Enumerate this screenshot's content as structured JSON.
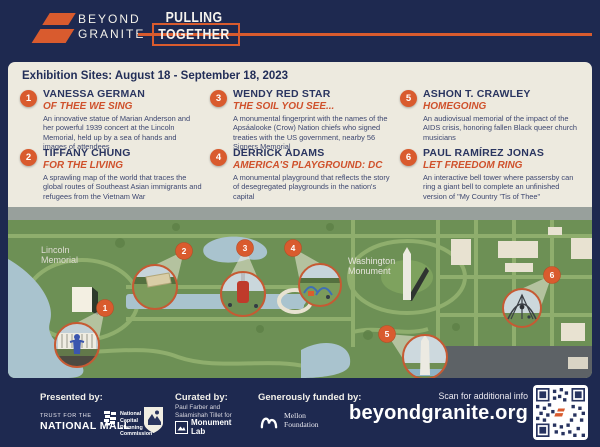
{
  "header": {
    "brand_line1": "BEYOND",
    "brand_line2": "GRANITE",
    "title_line1": "PULLING",
    "title_line2": "TOGETHER"
  },
  "banner": "Exhibition Sites: August 18 - September 18, 2023",
  "sites": [
    {
      "num": "1",
      "artist": "VANESSA GERMAN",
      "title": "OF THEE WE SING",
      "desc": "An innovative statue of Marian Anderson and her powerful 1939 concert at the Lincoln Memorial, held up by a sea of hands and images of attendees"
    },
    {
      "num": "2",
      "artist": "TIFFANY CHUNG",
      "title": "FOR THE LIVING",
      "desc": "A sprawling map of the world that traces the global routes of Southeast Asian immigrants and refugees from the Vietnam War"
    },
    {
      "num": "3",
      "artist": "WENDY RED STAR",
      "title": "THE SOIL YOU SEE...",
      "desc": "A monumental fingerprint with the names of the Apsáalooke (Crow) Nation chiefs who signed treaties with the US government, nearby 56 Signers Memorial"
    },
    {
      "num": "4",
      "artist": "DERRICK ADAMS",
      "title": "AMERICA'S PLAYGROUND: DC",
      "desc": "A monumental playground that reflects the story of desegregated playgrounds in the nation's capital"
    },
    {
      "num": "5",
      "artist": "ASHON T. CRAWLEY",
      "title": "HOMEGOING",
      "desc": "An audiovisual memorial of the impact of the AIDS crisis, honoring fallen Black queer church musicians"
    },
    {
      "num": "6",
      "artist": "PAUL RAMÍREZ JONAS",
      "title": "LET FREEDOM RING",
      "desc": "An interactive bell tower where passersby can ring a giant bell to complete an unfinished version of \"My Country 'Tis of Thee\""
    }
  ],
  "map": {
    "lincoln_label_line1": "Lincoln",
    "lincoln_label_line2": "Memorial",
    "washington_label_line1": "Washington",
    "washington_label_line2": "Monument",
    "markers": [
      "1",
      "2",
      "3",
      "4",
      "5",
      "6"
    ]
  },
  "footer": {
    "presented_by": "Presented by:",
    "trust_line1": "TRUST FOR THE",
    "trust_line2": "NATIONAL MALL",
    "ncpc_line1": "National",
    "ncpc_line2": "Capital",
    "ncpc_line3": "Planning",
    "ncpc_line4": "Commission",
    "curated_by": "Curated by:",
    "curators_line1": "Paul Farber and",
    "curators_line2": "Salamishah Tillet for",
    "monument_lab_line1": "Monument",
    "monument_lab_line2": "Lab",
    "funded_by": "Generously funded by:",
    "mellon_line1": "Mellon",
    "mellon_line2": "Foundation",
    "scan": "Scan for additional info",
    "url": "beyondgranite.org"
  },
  "colors": {
    "navy": "#1e2950",
    "cream": "#edeadf",
    "orange": "#d95b2e",
    "map_green": "#6d9055",
    "water": "#a9c3ce"
  }
}
